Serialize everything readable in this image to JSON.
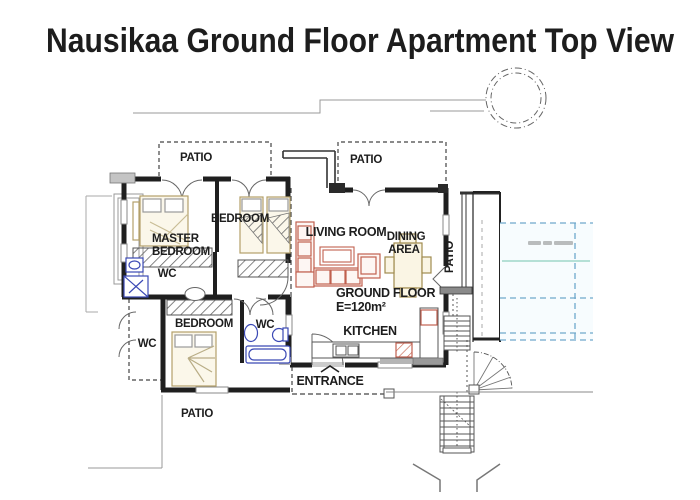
{
  "title": "Nausikaa Ground Floor Apartment Top View",
  "plan": {
    "area_label": {
      "line1": "GROUND FLOOR",
      "line2": "E=120m²"
    },
    "rooms": {
      "master_bedroom": {
        "line1": "MASTER",
        "line2": "BEDROOM"
      },
      "bedroom_top": {
        "label": "BEDROOM"
      },
      "bedroom_bottom": {
        "label": "BEDROOM"
      },
      "living_room": {
        "label": "LIVING ROOM"
      },
      "dining_area": {
        "line1": "DINING",
        "line2": "AREA"
      },
      "kitchen": {
        "label": "KITCHEN"
      },
      "wc_master": {
        "label": "WC"
      },
      "wc_annex": {
        "label": "WC"
      },
      "wc_bath": {
        "label": "WC"
      },
      "entrance": {
        "label": "ENTRANCE"
      }
    },
    "patios": {
      "top_left": {
        "label": "PATIO"
      },
      "top_right": {
        "label": "PATIO"
      },
      "right": {
        "label": "PATIO"
      },
      "bottom": {
        "label": "PATIO"
      }
    }
  },
  "colors": {
    "wall": "#1f1f1f",
    "boundary": "#999999",
    "furniture_wood": "#b3a06a",
    "sofa": "#c1604f",
    "plumbing": "#3b49b5",
    "pool_dashed": "#6fa8cc",
    "pool_teal": "#9fd6c8"
  }
}
